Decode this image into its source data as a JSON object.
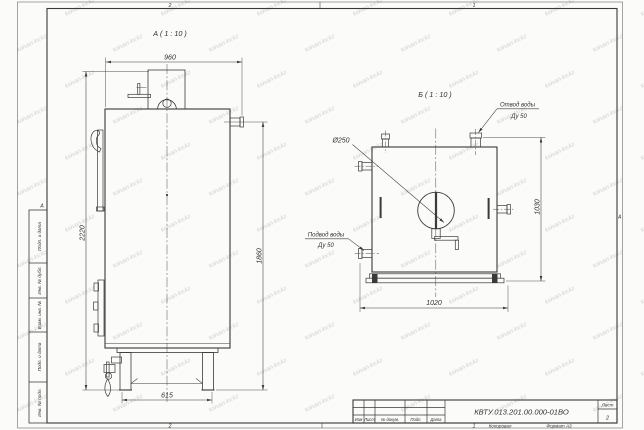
{
  "watermark": {
    "text": "kolvan-kv.kz"
  },
  "colors": {
    "paper": "#fbfbf9",
    "line": "#3a3a3a",
    "watermark": "#c9c9c6"
  },
  "frame": {
    "zone_top_left": "2",
    "zone_top_right": "1",
    "zone_bottom_left": "2",
    "zone_bottom_right": "1",
    "zone_left": "А",
    "zone_right": "А",
    "side_labels": [
      "Подп. и дата",
      "Инв. № дубл.",
      "Взам. инв. №",
      "Подп. и дата",
      "Инв. № подл."
    ]
  },
  "views": {
    "a": {
      "title": "А ( 1 : 10 )",
      "dims": {
        "depth": "960",
        "height_total": "2220",
        "height_outlet": "1860",
        "base_depth": "615"
      }
    },
    "b": {
      "title": "Б ( 1 : 10 )",
      "dims": {
        "width": "1020",
        "height": "1030",
        "flue_diameter": "Ø250"
      },
      "callouts": {
        "outlet_title": "Отвод воды",
        "outlet_size": "Ду 50",
        "inlet_title": "Подвод воды",
        "inlet_size": "Ду 50"
      }
    }
  },
  "title_block": {
    "designation": "КВТУ.013.201.00.000-01ВО",
    "sheet_label": "Лист",
    "sheet_number": "2",
    "columns": {
      "izm": "Изм",
      "list": "Лист",
      "doc": "№ докум.",
      "podp": "Подп.",
      "data": "Дата"
    },
    "footer": {
      "copied": "Копировал",
      "format": "Формат А3"
    }
  }
}
